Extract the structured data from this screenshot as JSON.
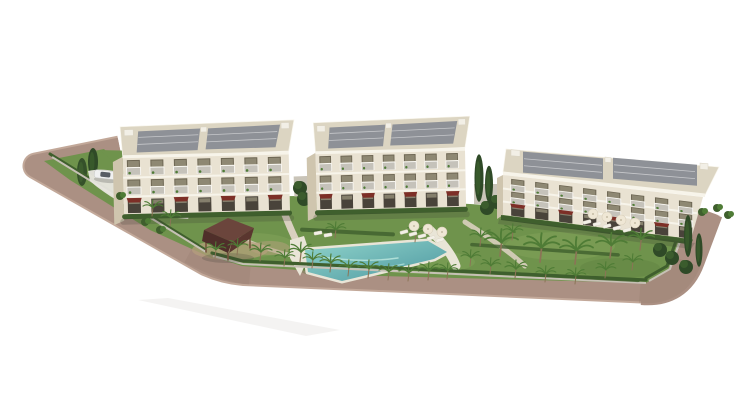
{
  "image": {
    "kind": "3d-architectural-rendering",
    "subject": "Aerial render of a residential complex: three cream low-rise apartment blocks with rooftop solar panels and balconies, landscaped gardens with palm trees and hedges, a turquoise swimming pool with sun loungers and parasols, a dark-roofed gazebo, a white car on the entrance driveway, and a taupe road wrapping the site on a white background",
    "background_color": "#ffffff",
    "canvas": {
      "width": 738,
      "height": 416
    }
  },
  "scene": {
    "buildings": [
      {
        "id": "building-1",
        "position": "left",
        "levels_visible": 4,
        "facade": "cream with glass balconies",
        "roof": "flat roof with solar panels",
        "accents": "dark red ground-floor awnings"
      },
      {
        "id": "building-2",
        "position": "center",
        "levels_visible": 4,
        "facade": "cream with glass balconies",
        "roof": "flat roof with solar panels",
        "accents": "dark red ground-floor awnings"
      },
      {
        "id": "building-3",
        "position": "right",
        "orientation": "angled toward front-left",
        "levels_visible": 4,
        "facade": "cream with glass balconies",
        "roof": "flat roof with solar panels",
        "accents": "dark red ground-floor awnings"
      }
    ],
    "landscape": {
      "pool": "elongated free-form turquoise pool with light stone deck",
      "gazebo": "dark hip-roof timber gazebo on a paved terrace",
      "vegetation": [
        "palm trees",
        "hedges",
        "cypresses",
        "lawns",
        "shrubs"
      ],
      "furniture": [
        "white sun loungers",
        "cream parasols"
      ],
      "road": "taupe perimeter road along the west and south boundary",
      "vehicle": "white car on entrance driveway",
      "fencing": "light fence with green hedge along the site boundary"
    }
  },
  "colors": {
    "bg": "#ffffff",
    "road": "#ab9083",
    "roadEdge": "#c2a899",
    "roadShade": "#8a7163",
    "grass": "#6f934c",
    "grassLight": "#84a75d",
    "grassDark": "#59793b",
    "hedge": "#3f5f2d",
    "frond": "#4f7c36",
    "trunk": "#8b7456",
    "tree": "#2f4a27",
    "cypress": "#3b5c2d",
    "facade": "#e9e2d2",
    "facadeSide": "#cfc5ae",
    "trim": "#f7f4ea",
    "roofDeck": "#dcd5c2",
    "panel": "#8e9197",
    "roofBox": "#f2efe6",
    "glass": "#6e6754",
    "glassDark": "#49433a",
    "windowLight": "#9a937e",
    "rail": "rgba(255,255,255,0.6)",
    "awning": "#7d2f27",
    "gazeboTop": "#6b453c",
    "gazeboFront": "#4f2f2a",
    "gazeboSide": "#5a362f",
    "gazeboPost": "#74523d",
    "deck": "#e9e5d7",
    "path": "#d9d0bf",
    "dirt": "#b69f7e",
    "poolA": "#8fd3ca",
    "poolB": "#4e98a1",
    "umbrella": "#efe7d5",
    "lounger": "#f3f0e7",
    "wall": "#c9c4b8",
    "fence": "#c6c1b5",
    "shadow": "rgba(60,60,50,0.22)",
    "car": "#f0f1f1",
    "carGlass": "#3c434b",
    "streak": "#8f867c"
  }
}
